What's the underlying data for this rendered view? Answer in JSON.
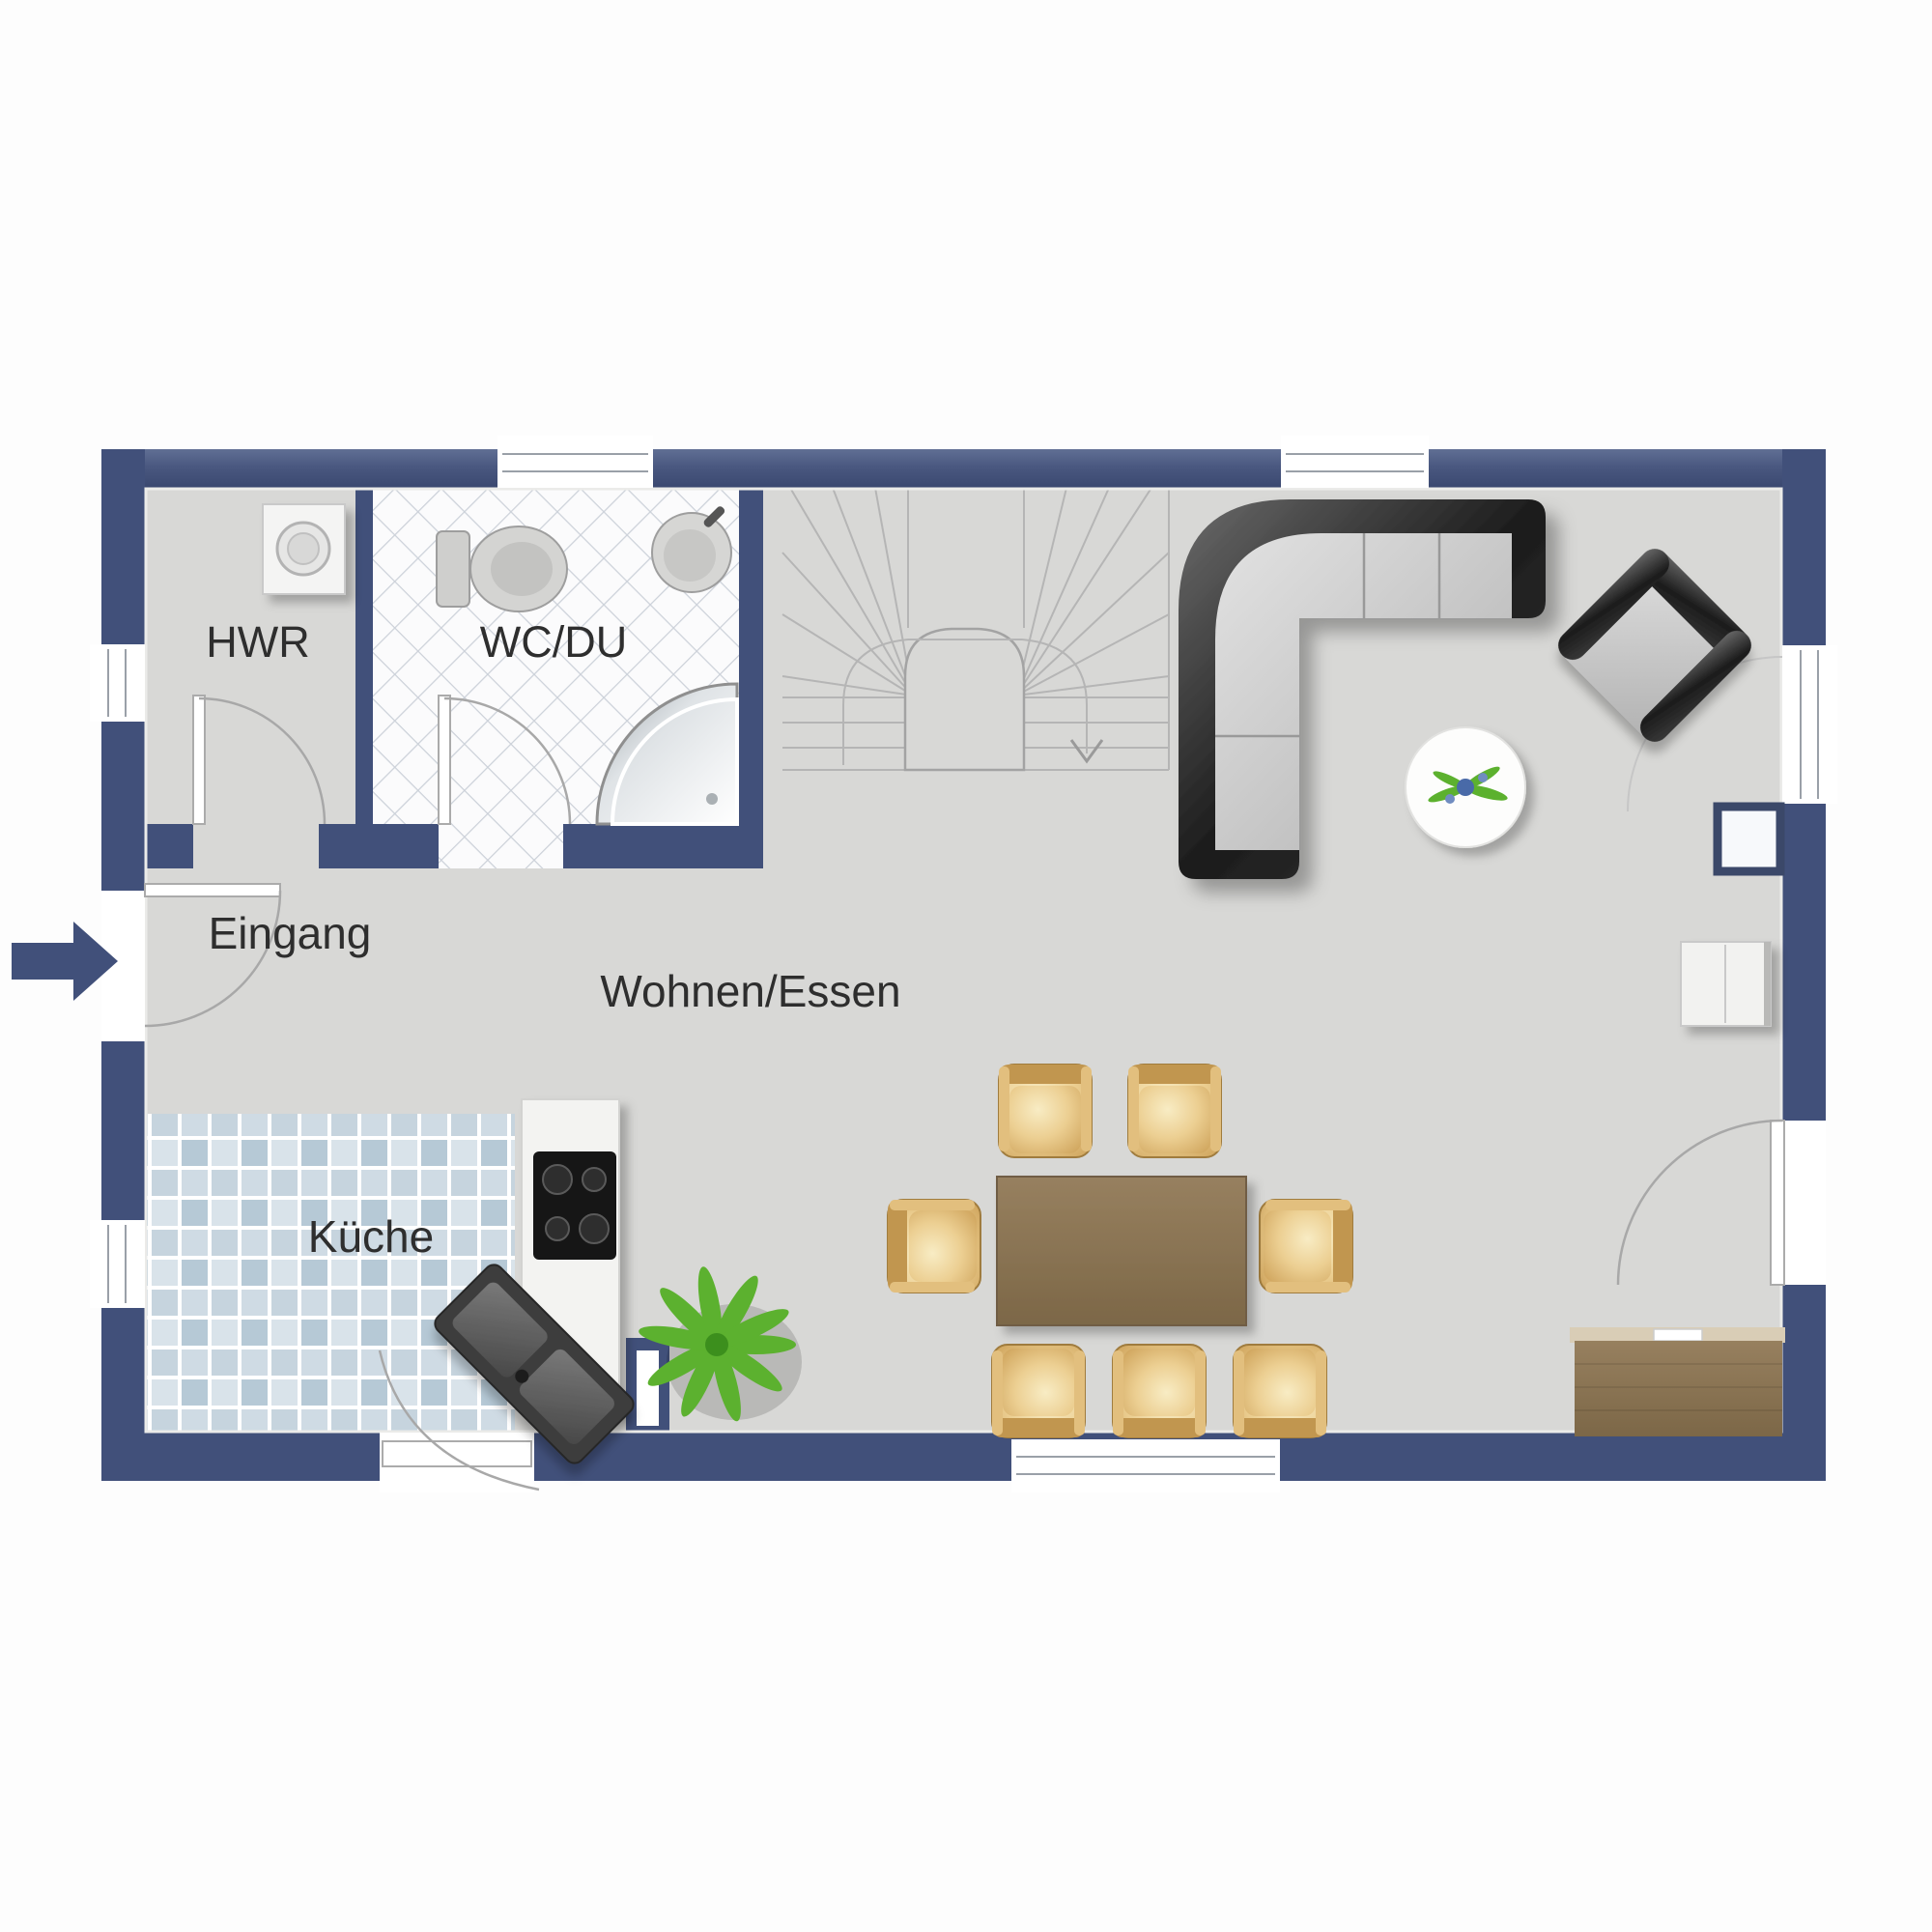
{
  "rooms": {
    "hwr": "HWR",
    "wc": "WC/DU",
    "entrance": "Eingang",
    "living": "Wohnen/Essen",
    "kitchen": "Küche"
  },
  "icons": {
    "entrance_marker": "entrance-arrow",
    "stair_direction": "down-chevron-arrow"
  },
  "colors": {
    "wall": "#41507a",
    "wall_hi": "#5f6e93",
    "floor": "#d8d8d6",
    "tile_a": "#b6c9d6",
    "tile_b": "#d9e3ea",
    "tile_c": "#c6d4de",
    "tile_d": "#cfdbe4",
    "grout": "#ffffff",
    "wc_tile_line": "#ccd1d9",
    "wood": "#8b7354",
    "wood_dark": "#73604a",
    "chair_hi": "#f6e5b4",
    "chair_mid": "#e2bf7e",
    "chair_dark": "#c1964f",
    "chair_edge": "#a07c3e",
    "sofa_dark": "#262626",
    "seat_hi": "#dedede",
    "seat_lo": "#b5b5b5",
    "line_gray": "#a8a8a8",
    "stair_line": "#b5b5b5",
    "counter": "#f3f3f1",
    "cooktop": "#161616",
    "metal": "#4a4a4a",
    "plant_green": "#5cb12f",
    "plant_green_dark": "#3c8f1d",
    "plant_green_light": "#8ed45e"
  }
}
